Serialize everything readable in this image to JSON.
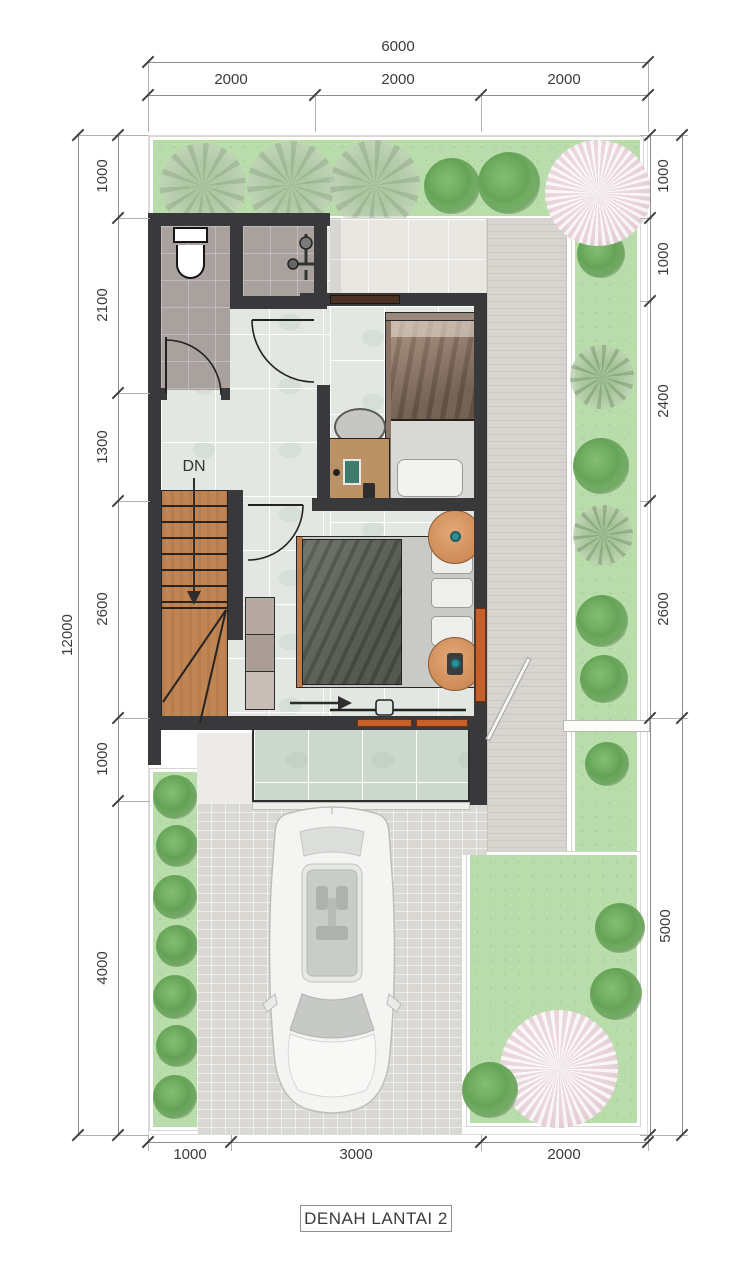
{
  "title": "DENAH LANTAI 2",
  "plan": {
    "stairs_label": "DN",
    "dimensions": {
      "top": {
        "total": "6000",
        "segments": [
          "2000",
          "2000",
          "2000"
        ]
      },
      "bottom": {
        "segments": [
          "1000",
          "3000",
          "2000"
        ]
      },
      "left": {
        "total": "12000",
        "segments": [
          "1000",
          "2100",
          "1300",
          "2600",
          "1000",
          "4000"
        ]
      },
      "right": {
        "segments": [
          "1000",
          "1000",
          "2400",
          "2600",
          "5000"
        ]
      }
    },
    "colors": {
      "wall": "#39393b",
      "stair_wood": "#c08552",
      "lawn": "#b9dcab",
      "window_accent": "#c6602b",
      "interior_marble": "#e2e7e2",
      "bathroom_tile": "#a8a19d",
      "deck": "#d6d2cd",
      "dimension_text": "#3b3b3b"
    }
  }
}
